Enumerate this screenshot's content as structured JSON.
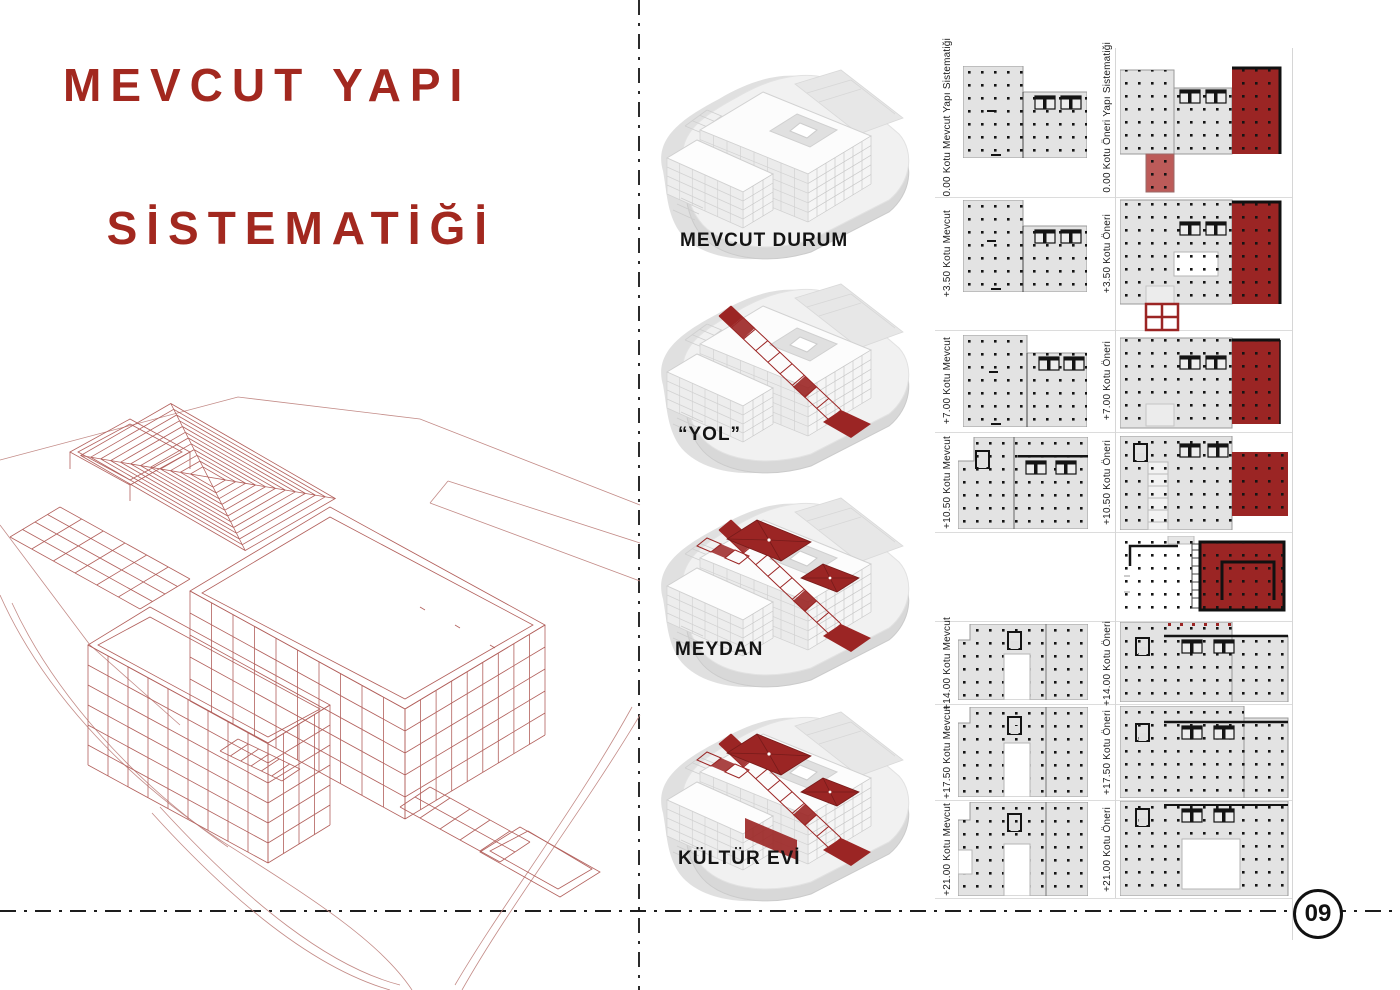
{
  "header": {
    "line1": "MEVCUT YAPI",
    "line2": "SİSTEMATİĞİ"
  },
  "axons": [
    {
      "label": "MEVCUT DURUM"
    },
    {
      "label": "“YOL”"
    },
    {
      "label": "MEYDAN"
    },
    {
      "label": "KÜLTÜR EVİ"
    }
  ],
  "plans": {
    "rows": [
      {
        "mevcut_label": "0.00 Kotu Mevcut Yapı Sistematiği",
        "oneri_label": "0.00 Kotu Öneri Yapı Sistematiği"
      },
      {
        "mevcut_label": "+3.50 Kotu Mevcut",
        "oneri_label": "+3.50 Kotu Öneri"
      },
      {
        "mevcut_label": "+7.00 Kotu Mevcut",
        "oneri_label": "+7.00 Kotu Öneri"
      },
      {
        "mevcut_label": "+10.50 Kotu Mevcut",
        "oneri_label": "+10.50 Kotu Öneri"
      },
      {
        "mevcut_label": "",
        "oneri_label": ""
      },
      {
        "mevcut_label": "+14.00 Kotu Mevcut",
        "oneri_label": "+14.00 Kotu Öneri"
      },
      {
        "mevcut_label": "+17.50 Kotu Mevcut",
        "oneri_label": "+17.50 Kotu Öneri"
      },
      {
        "mevcut_label": "+21.00 Kotu Mevcut",
        "oneri_label": "+21.00 Kotu Öneri"
      }
    ]
  },
  "footer": {
    "page_number": "09"
  },
  "colors": {
    "accent_red": "#9B2524",
    "light_red": "#BC5B59",
    "title_red": "#A2281F",
    "wireframe_red": "#B2605C",
    "plan_gray": "#E3E3E3"
  }
}
